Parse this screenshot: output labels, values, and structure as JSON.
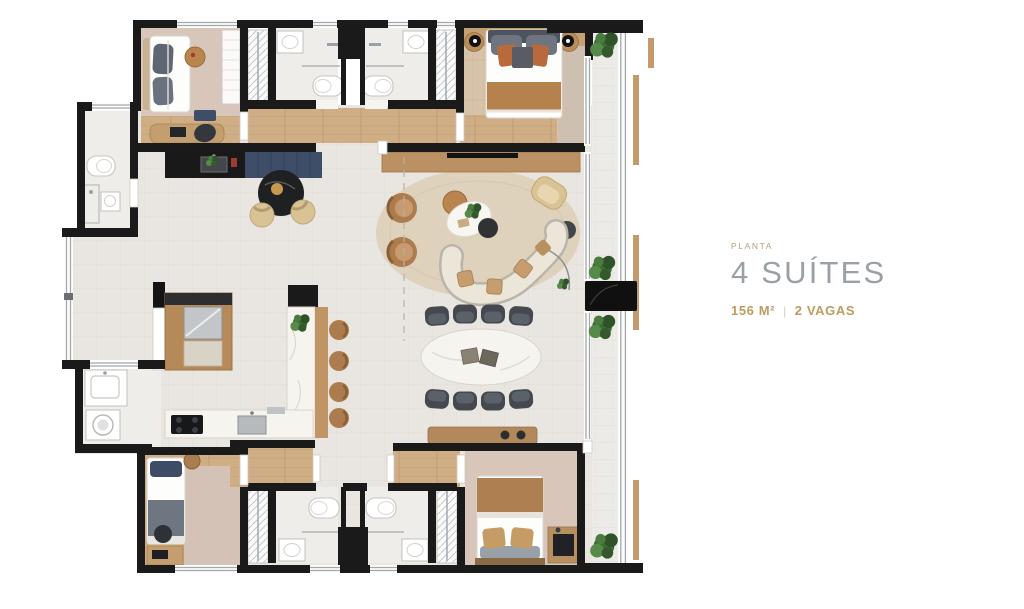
{
  "info_panel": {
    "eyebrow": "PLANTA",
    "title": "4 SUÍTES",
    "stats": {
      "area": "156 M²",
      "separator": "|",
      "parking": "2 VAGAS"
    }
  },
  "palette": {
    "page": "#ffffff",
    "wall": "#1a1a1a",
    "tile": "#e9e6e1",
    "tileLine": "#dfdad2",
    "balconyTile": "#edebe7",
    "wood": "#cfae85",
    "woodLine": "#b99467",
    "woodDark": "#b68a58",
    "woodDeep": "#9a7243",
    "woodFloor": "#d7c3a8",
    "carpet": "#d8c6ba",
    "carpetWarm": "#d3bfa6",
    "navy": "#3e4e68",
    "counterBlack": "#191919",
    "marble": "#f6f4ee",
    "marbleLine": "#d9d4ca",
    "rug": "#ded2bd",
    "chairDark": "#45494f",
    "chairDarkLight": "#5b6169",
    "leather": "#ad7c4e",
    "leatherDark": "#8a5f36",
    "green": "#3c6a35",
    "greenDark": "#2e5329",
    "greenLight": "#568a49",
    "beige": "#d9c293",
    "sofaCream": "#ece6d9",
    "sofaFrame": "#b9b5ab",
    "terracotta": "#b96a3c",
    "stainless": "#c3c6c8",
    "glassLine": "#a3a8ab",
    "fixtureStroke": "#c7c5bf",
    "eyebrow": "#b3a07b",
    "titleGray": "#9aa1a6",
    "gold": "#bd9c5f",
    "sepColor": "#d6d0c4"
  }
}
